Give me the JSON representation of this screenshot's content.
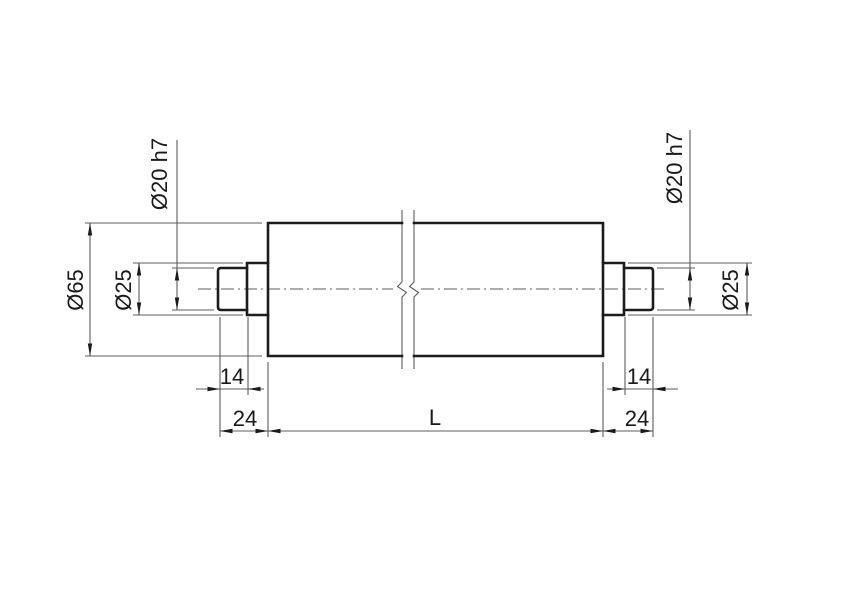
{
  "drawing": {
    "type": "technical-drawing",
    "part": "roller with stepped shaft journals, broken-out middle section",
    "units": "mm",
    "colors": {
      "background": "#ffffff",
      "outline": "#1c1c1c",
      "thin_line": "#5d5d5d",
      "text": "#1a1a1a"
    },
    "labels": {
      "body_diameter": "Ø65",
      "left_step_diameter": "Ø25",
      "left_end_diameter": "Ø20 h7",
      "right_end_diameter": "Ø20 h7",
      "right_step_diameter": "Ø25",
      "left_end_length": "14",
      "left_overhang_length": "24",
      "body_length": "L",
      "right_end_length": "14",
      "right_overhang_length": "24"
    },
    "dimension_values": {
      "body_diameter_mm": 65,
      "step_diameter_mm": 25,
      "journal_diameter_mm": 20,
      "journal_fit": "h7",
      "journal_length_mm": 14,
      "end_overhang_mm": 24,
      "body_length": "L"
    }
  }
}
